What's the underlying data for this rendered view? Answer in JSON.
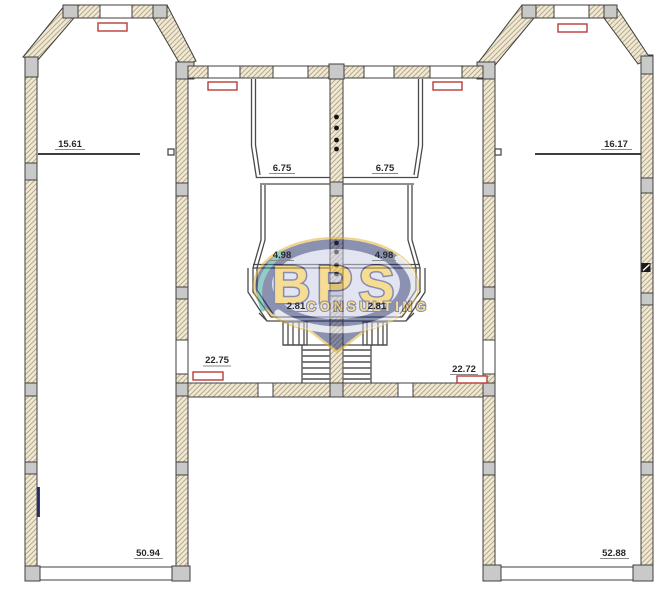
{
  "meta": {
    "type": "architectural-floor-plan"
  },
  "rooms": {
    "left_wing_upper": "15.61",
    "left_wing_lower": "50.94",
    "right_wing_upper": "16.17",
    "right_wing_lower": "52.88",
    "center_left_top": "6.75",
    "center_right_top": "6.75",
    "center_left_mid": "4.98",
    "center_right_mid": "4.98",
    "center_left_bay": "2.81",
    "center_right_bay": "2.81",
    "center_left_hall": "22.75",
    "center_right_hall": "22.72"
  },
  "watermark": {
    "name": "BPS",
    "subtitle": "CONSULTING",
    "navy": "#232e6a",
    "gold": "#f0bd33",
    "inner": "#c9cce8",
    "teal": "#2fa193"
  },
  "colors": {
    "background": "#ffffff",
    "wall_fill": "#f0e9d8",
    "wall_hatch": "#b9aa85",
    "wall_outline": "#3f3f3f",
    "column_fill": "#c9c9c9",
    "radiator": "#b83c3c",
    "partition": "#4a4a4a",
    "label_text": "#2a2a2a",
    "door_marker_navy": "#1f2a66"
  }
}
